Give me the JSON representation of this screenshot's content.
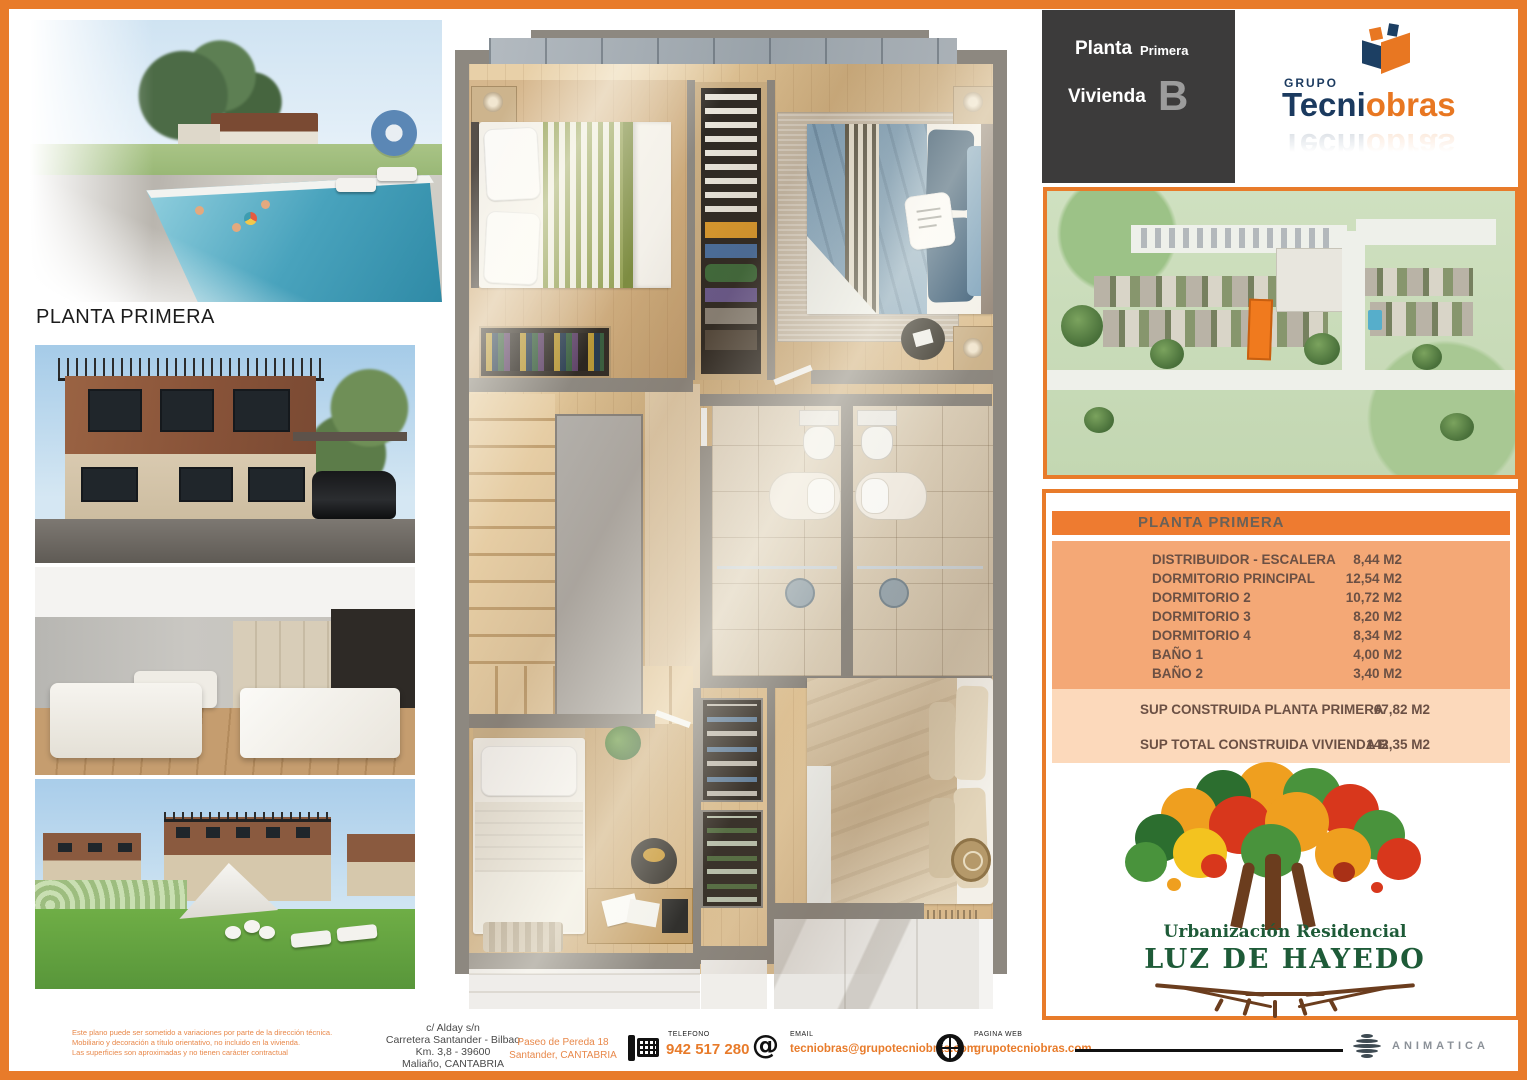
{
  "page": {
    "accent_orange": "#e87b2a",
    "title_left": "PLANTA PRIMERA"
  },
  "header_box": {
    "planta_label": "Planta",
    "planta_value": "Primera",
    "vivienda_label": "Vivienda",
    "vivienda_value": "B"
  },
  "brand": {
    "grupo": "GRUPO",
    "name_primary": "Tecni",
    "name_secondary": "obras"
  },
  "area_table": {
    "header": "PLANTA PRIMERA",
    "rows": [
      {
        "label": "DISTRIBUIDOR - ESCALERA",
        "value": "8,44 M2"
      },
      {
        "label": "DORMITORIO PRINCIPAL",
        "value": "12,54 M2"
      },
      {
        "label": "DORMITORIO 2",
        "value": "10,72 M2"
      },
      {
        "label": "DORMITORIO 3",
        "value": "8,20 M2"
      },
      {
        "label": "DORMITORIO 4",
        "value": "8,34 M2"
      },
      {
        "label": "BAÑO 1",
        "value": "4,00 M2"
      },
      {
        "label": "BAÑO 2",
        "value": "3,40 M2"
      }
    ],
    "summary": [
      {
        "label": "SUP CONSTRUIDA  PLANTA PRIMERA",
        "value": "67,82 M2"
      },
      {
        "label": "SUP TOTAL CONSTRUIDA VIVIENDA B",
        "value": "142,35 M2"
      }
    ]
  },
  "development_logo": {
    "line1": "Urbanización Residencial",
    "line2": "LUZ DE HAYEDO"
  },
  "footer": {
    "disclaimer": [
      "Este plano puede ser sometido a variaciones por parte de la dirección técnica.",
      "Mobiliario y decoración a título orientativo, no incluido en la vivienda.",
      "Las superficies son aproximadas y no tienen carácter contractual"
    ],
    "address1": [
      "c/ Alday s/n",
      "Carretera Santander - Bilbao",
      "Km. 3,8 - 39600",
      "Maliaño, CANTABRIA"
    ],
    "address2": [
      "Paseo de Pereda 18",
      "Santander, CANTABRIA"
    ],
    "phone_label": "TELEFONO",
    "phone": "942 517 280",
    "email_label": "EMAIL",
    "email": "tecniobras@grupotecniobras.com",
    "web_label": "PAGINA WEB",
    "web": "grupotecniobras.com",
    "studio": "ANIMATICA"
  }
}
